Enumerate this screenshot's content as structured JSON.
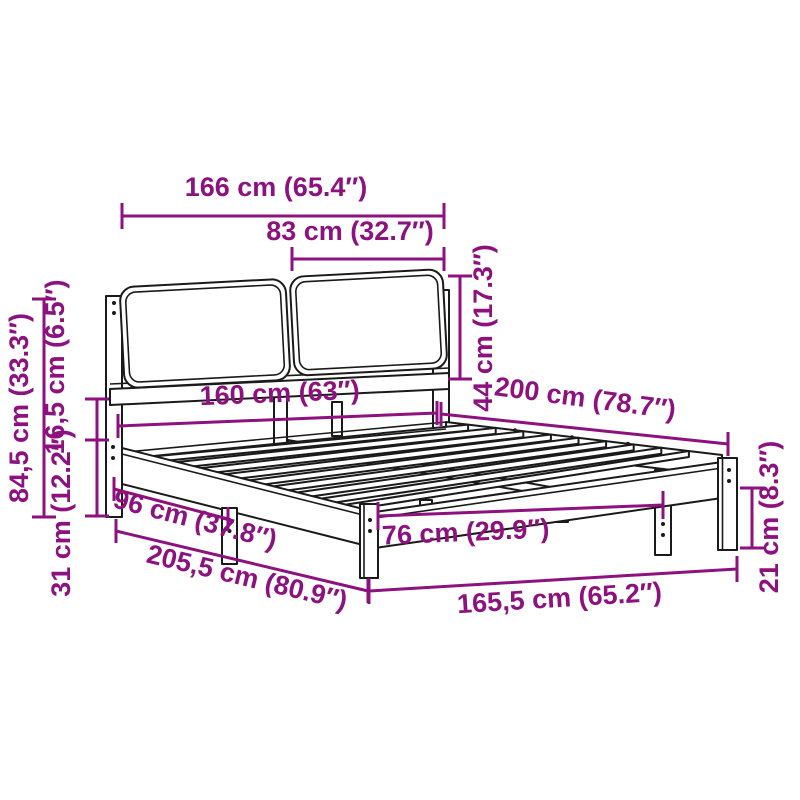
{
  "diagram": {
    "type": "product-dimension-diagram",
    "subject": "bed frame with two-panel upholstered headboard, slatted base",
    "colors": {
      "dimension_accent": "#8D117F",
      "drawing_line": "#1A1A1A",
      "background": "#FFFFFF"
    },
    "dimensions": [
      {
        "name": "headboard-outer-width",
        "label": "166 cm (65.4″)",
        "cm": "166",
        "inch": "65.4"
      },
      {
        "name": "headboard-panel-width",
        "label": "83 cm (32.7″)",
        "cm": "83",
        "inch": "32.7"
      },
      {
        "name": "headboard-panel-height",
        "label": "44 cm (17.3″)",
        "cm": "44",
        "inch": "17.3"
      },
      {
        "name": "headboard-total-height",
        "label": "84,5 cm (33.3″)",
        "cm": "84,5",
        "inch": "33.3"
      },
      {
        "name": "frame-rail-height",
        "label": "16,5 cm (6.5″)",
        "cm": "16,5",
        "inch": "6.5"
      },
      {
        "name": "under-bed-clearance",
        "label": "31 cm (12.2″)",
        "cm": "31",
        "inch": "12.2"
      },
      {
        "name": "side-leg-spacing",
        "label": "96 cm (37.8″)",
        "cm": "96",
        "inch": "37.8"
      },
      {
        "name": "total-length",
        "label": "205,5 cm (80.9″)",
        "cm": "205,5",
        "inch": "80.9"
      },
      {
        "name": "mattress-width",
        "label": "160 cm (63″)",
        "cm": "160",
        "inch": "63"
      },
      {
        "name": "mattress-length",
        "label": "200 cm (78.7″)",
        "cm": "200",
        "inch": "78.7"
      },
      {
        "name": "center-leg-spacing",
        "label": "76 cm (29.9″)",
        "cm": "76",
        "inch": "29.9"
      },
      {
        "name": "total-width-at-foot",
        "label": "165,5 cm (65.2″)",
        "cm": "165,5",
        "inch": "65.2"
      },
      {
        "name": "foot-leg-height",
        "label": "21 cm (8.3″)",
        "cm": "21",
        "inch": "8.3"
      }
    ]
  }
}
